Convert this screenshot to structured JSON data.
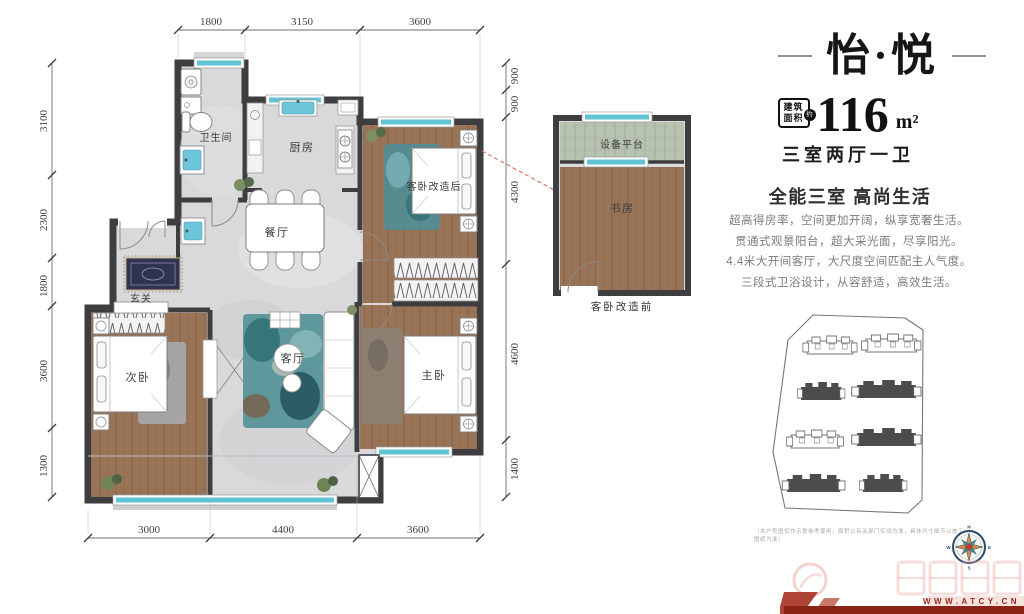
{
  "header": {
    "title": "怡·悦",
    "area_badge": {
      "line1": "建筑",
      "line2": "面积",
      "approx": "约"
    },
    "area_value": "116",
    "area_unit": "m²",
    "layout_spec": "三室两厅一卫"
  },
  "selling": {
    "headline": "全能三室 高尚生活",
    "lines": [
      "超高得房率，空间更加开阔，纵享宽奢生活。",
      "贯通式观景阳台，超大采光面，尽享阳光。",
      "4.4米大开间客厅，大尺度空间匹配主人气度。",
      "三段式卫浴设计，从容舒适，高效生活。"
    ]
  },
  "floorplan": {
    "rooms": {
      "bathroom": "卫生间",
      "kitchen": "厨房",
      "dining": "餐厅",
      "guest_after": "客卧改造后",
      "entry": "玄关",
      "second_bedroom": "次卧",
      "living": "客厅",
      "master_bedroom": "主卧"
    },
    "dims_top": [
      "1800",
      "3150",
      "3600"
    ],
    "dims_bottom": [
      "3000",
      "4400",
      "3600"
    ],
    "dims_left": [
      "3100",
      "2300",
      "1800",
      "3600",
      "1300"
    ],
    "dims_right": [
      "900",
      "900",
      "4300",
      "4600",
      "1400"
    ]
  },
  "inset": {
    "platform": "设备平台",
    "study": "书房",
    "caption": "客卧改造前"
  },
  "compass": {
    "n": "N",
    "e": "E",
    "s": "S",
    "w": "W"
  },
  "footer": {
    "disclaimer": "（本户型图仅作示意参考使用，面积以有关部门实测为准，具体尺寸细节以施工图纸为准）",
    "watermark": "WWW.ATCY.CN"
  },
  "colors": {
    "wall": "#3e3e40",
    "window_cyan": "#62c3d5",
    "wood": "#9a7456",
    "accent_red": "#d96b5b",
    "watermark_red": "#9b2a1b"
  }
}
